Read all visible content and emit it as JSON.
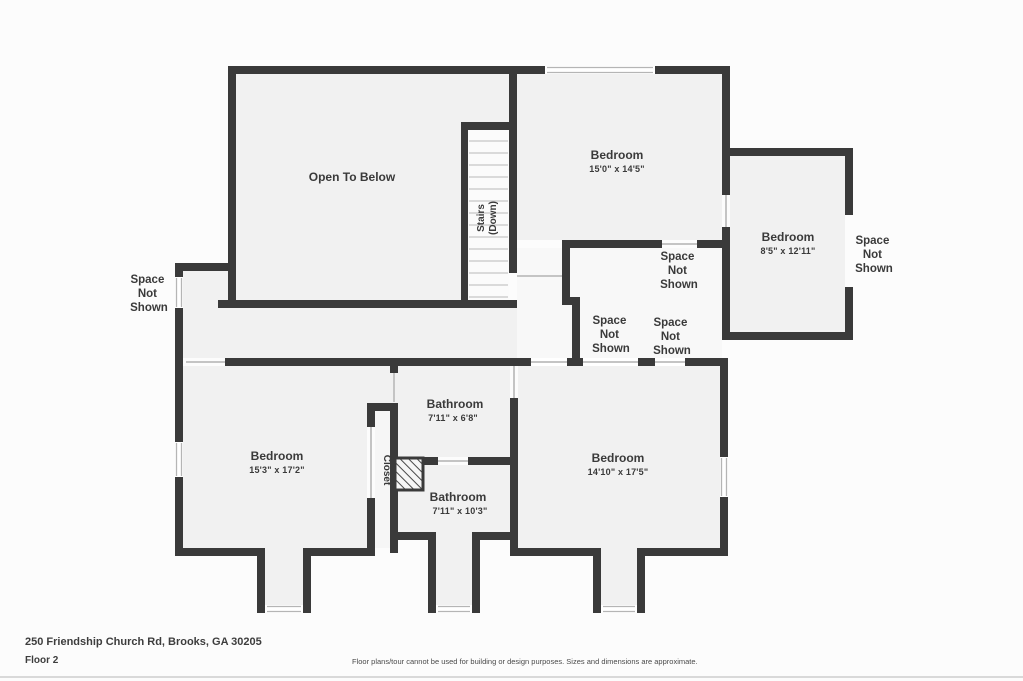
{
  "title": "Floor plan - Floor 2",
  "colors": {
    "wall": "#3a3a3a",
    "room_fill": "#f1f1f1",
    "space_fill": "#f8f8f8",
    "stairs_fill": "#fbfbfb",
    "background": "#fcfcfc",
    "text": "#3a3a3a",
    "opening_line": "#c4c4c4"
  },
  "labels": {
    "open_to_below": "Open To Below",
    "stairs_line1": "Stairs",
    "stairs_line2": "(Down)",
    "closet": "Closet",
    "space_not_shown": [
      "Space",
      "Not",
      "Shown"
    ]
  },
  "rooms": [
    {
      "name": "Bedroom",
      "dims": "15'0\" x 14'5\""
    },
    {
      "name": "Bedroom",
      "dims": "8'5\" x 12'11\""
    },
    {
      "name": "Bedroom",
      "dims": "15'3\" x 17'2\""
    },
    {
      "name": "Bedroom",
      "dims": "14'10\" x 17'5\""
    },
    {
      "name": "Bathroom",
      "dims": "7'11\" x 6'8\""
    },
    {
      "name": "Bathroom",
      "dims": "7'11\" x 10'3\""
    }
  ],
  "footer": {
    "address": "250 Friendship Church Rd, Brooks, GA 30205",
    "floor": "Floor 2",
    "disclaimer": "Floor plans/tour cannot be used for building or design purposes. Sizes and dimensions are approximate."
  }
}
